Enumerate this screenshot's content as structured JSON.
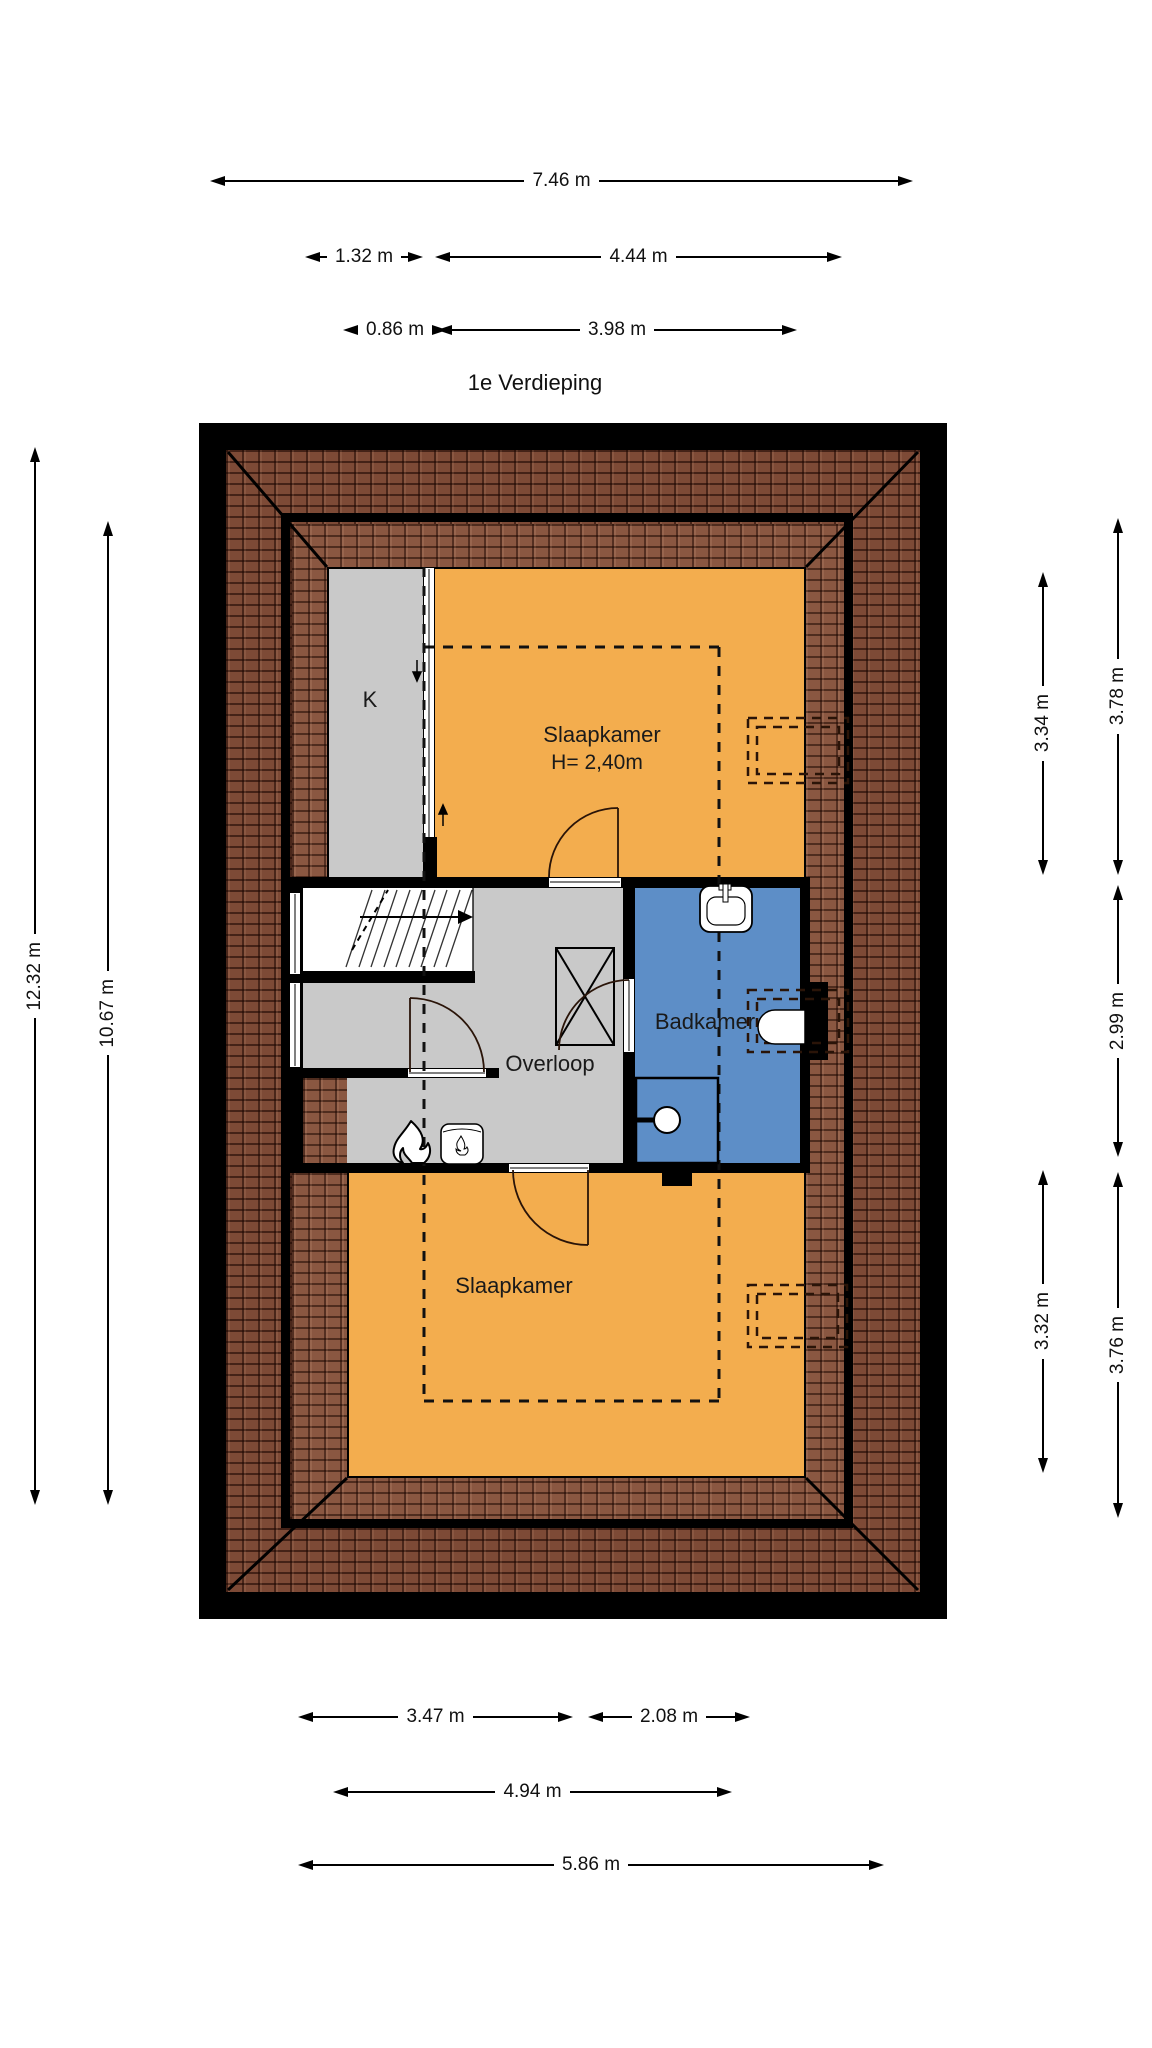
{
  "title": "1e Verdieping",
  "dimensions": {
    "top": [
      "7.46 m",
      "1.32 m",
      "4.44 m",
      "0.86 m",
      "3.98 m"
    ],
    "left": [
      "12.32 m",
      "10.67 m"
    ],
    "right": [
      "3.34 m",
      "3.78 m",
      "2.99 m",
      "3.32 m",
      "3.76 m"
    ],
    "bottom": [
      "3.47 m",
      "2.08 m",
      "4.94 m",
      "5.86 m"
    ]
  },
  "rooms": {
    "closet": {
      "label": "K"
    },
    "bedroom_top": {
      "label": "Slaapkamer",
      "ceiling_height": "H= 2,40m"
    },
    "landing": {
      "label": "Overloop"
    },
    "bathroom": {
      "label": "Badkamer"
    },
    "bedroom_bottom": {
      "label": "Slaapkamer"
    }
  },
  "colors": {
    "room_fill": "#f3ad4e",
    "bathroom_fill": "#5d8ec7",
    "floor_fill": "#c9c9c9",
    "roof_outer": "#7d4a36",
    "roof_inner": "#8a5741",
    "wall": "#000000"
  },
  "icons": [
    "fireplace-flame-icon",
    "boiler-icon",
    "sink-icon",
    "toilet-icon",
    "shower-icon",
    "roof-window-icon",
    "stairs-up-arrow-icon"
  ]
}
